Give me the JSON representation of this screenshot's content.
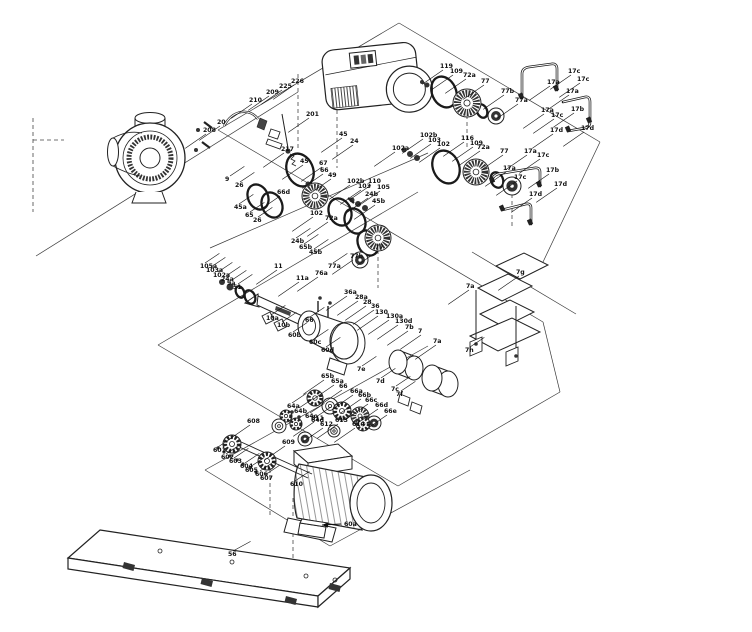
{
  "figure": {
    "type": "exploded-parts-diagram",
    "subject": "Pump assembly exploded view with numbered part callouts",
    "background_color": "#ffffff",
    "line_color": "#1a1a1a"
  },
  "part_groups": {
    "pump_head": [
      "20",
      "201",
      "208",
      "209",
      "210",
      "217",
      "225",
      "226"
    ],
    "hydraulics": [
      "9",
      "9a",
      "10a",
      "10b",
      "11",
      "11a",
      "24",
      "24a",
      "24b",
      "26",
      "45",
      "45a",
      "45b",
      "49",
      "51",
      "65",
      "65a",
      "65b",
      "66",
      "66a",
      "66b",
      "66c",
      "66d",
      "66e",
      "67",
      "76a"
    ],
    "shaft_seals": [
      "72a",
      "77",
      "77a",
      "77b",
      "102",
      "102a",
      "102b",
      "103",
      "103a",
      "105",
      "105a",
      "109",
      "110",
      "116",
      "119"
    ],
    "piping": [
      "17a",
      "17b",
      "17c",
      "17d"
    ],
    "guards_and_mounts": [
      "7",
      "7a",
      "7b",
      "7c",
      "7d",
      "7e",
      "7f",
      "7g",
      "7h",
      "28",
      "28a",
      "36",
      "36a",
      "56",
      "60a",
      "60b",
      "60c",
      "60d",
      "64a",
      "64b",
      "64c",
      "64d",
      "130",
      "130a",
      "130d"
    ],
    "fasteners": [
      "601",
      "602",
      "603",
      "604",
      "605",
      "606",
      "607",
      "608",
      "609",
      "610",
      "611",
      "612",
      "613",
      "614"
    ]
  },
  "callouts": [
    {
      "t": "208",
      "x": 203,
      "y": 132
    },
    {
      "t": "20",
      "x": 217,
      "y": 124
    },
    {
      "t": "210",
      "x": 249,
      "y": 102
    },
    {
      "t": "209",
      "x": 266,
      "y": 94
    },
    {
      "t": "225",
      "x": 279,
      "y": 88
    },
    {
      "t": "226",
      "x": 291,
      "y": 83
    },
    {
      "t": "201",
      "x": 306,
      "y": 116
    },
    {
      "t": "217",
      "x": 281,
      "y": 151
    },
    {
      "t": "9",
      "x": 225,
      "y": 181,
      "d": [
        9,
        -6
      ]
    },
    {
      "t": "26",
      "x": 235,
      "y": 187,
      "d": [
        9,
        -6
      ]
    },
    {
      "t": "45",
      "x": 339,
      "y": 136
    },
    {
      "t": "24",
      "x": 350,
      "y": 143
    },
    {
      "t": "45",
      "x": 300,
      "y": 163
    },
    {
      "t": "67",
      "x": 319,
      "y": 165
    },
    {
      "t": "66",
      "x": 320,
      "y": 172
    },
    {
      "t": "49",
      "x": 328,
      "y": 177
    },
    {
      "t": "66d",
      "x": 277,
      "y": 194
    },
    {
      "t": "45a",
      "x": 234,
      "y": 209,
      "d": [
        9,
        -6
      ]
    },
    {
      "t": "65",
      "x": 245,
      "y": 217,
      "d": [
        9,
        -6
      ]
    },
    {
      "t": "26",
      "x": 253,
      "y": 222,
      "d": [
        9,
        -6
      ]
    },
    {
      "t": "102b",
      "x": 347,
      "y": 183
    },
    {
      "t": "103",
      "x": 358,
      "y": 188
    },
    {
      "t": "110",
      "x": 368,
      "y": 183
    },
    {
      "t": "105",
      "x": 377,
      "y": 189
    },
    {
      "t": "24b",
      "x": 365,
      "y": 196
    },
    {
      "t": "45b",
      "x": 372,
      "y": 203
    },
    {
      "t": "102",
      "x": 310,
      "y": 215
    },
    {
      "t": "72a",
      "x": 325,
      "y": 220
    },
    {
      "t": "24b",
      "x": 291,
      "y": 243,
      "d": [
        9,
        -6
      ]
    },
    {
      "t": "65b",
      "x": 299,
      "y": 249,
      "d": [
        9,
        -6
      ]
    },
    {
      "t": "45b",
      "x": 309,
      "y": 254,
      "d": [
        9,
        -6
      ]
    },
    {
      "t": "77",
      "x": 375,
      "y": 249
    },
    {
      "t": "77b",
      "x": 350,
      "y": 258
    },
    {
      "t": "77a",
      "x": 328,
      "y": 268,
      "d": [
        9,
        -6
      ]
    },
    {
      "t": "102a",
      "x": 392,
      "y": 150
    },
    {
      "t": "102b",
      "x": 420,
      "y": 137
    },
    {
      "t": "103",
      "x": 428,
      "y": 142
    },
    {
      "t": "102",
      "x": 437,
      "y": 146
    },
    {
      "t": "116",
      "x": 461,
      "y": 140
    },
    {
      "t": "109",
      "x": 470,
      "y": 145
    },
    {
      "t": "72a",
      "x": 477,
      "y": 149
    },
    {
      "t": "77",
      "x": 500,
      "y": 153
    },
    {
      "t": "119",
      "x": 440,
      "y": 68
    },
    {
      "t": "109",
      "x": 450,
      "y": 73
    },
    {
      "t": "72a",
      "x": 463,
      "y": 77
    },
    {
      "t": "77",
      "x": 481,
      "y": 83
    },
    {
      "t": "77b",
      "x": 501,
      "y": 93
    },
    {
      "t": "77a",
      "x": 515,
      "y": 102
    },
    {
      "t": "17c",
      "x": 568,
      "y": 73
    },
    {
      "t": "17a",
      "x": 547,
      "y": 84
    },
    {
      "t": "17c",
      "x": 577,
      "y": 81
    },
    {
      "t": "17a",
      "x": 566,
      "y": 93
    },
    {
      "t": "17b",
      "x": 571,
      "y": 111
    },
    {
      "t": "17a",
      "x": 541,
      "y": 112
    },
    {
      "t": "17c",
      "x": 551,
      "y": 117
    },
    {
      "t": "17d",
      "x": 581,
      "y": 130
    },
    {
      "t": "17d",
      "x": 550,
      "y": 132
    },
    {
      "t": "17a",
      "x": 524,
      "y": 153
    },
    {
      "t": "17c",
      "x": 537,
      "y": 157
    },
    {
      "t": "17a",
      "x": 503,
      "y": 170
    },
    {
      "t": "17b",
      "x": 546,
      "y": 172
    },
    {
      "t": "17c",
      "x": 514,
      "y": 179
    },
    {
      "t": "17d",
      "x": 554,
      "y": 186
    },
    {
      "t": "17d",
      "x": 529,
      "y": 196
    },
    {
      "t": "105a",
      "x": 200,
      "y": 268,
      "d": [
        9,
        -6
      ]
    },
    {
      "t": "103a",
      "x": 206,
      "y": 272,
      "d": [
        9,
        -6
      ]
    },
    {
      "t": "102a",
      "x": 213,
      "y": 277,
      "d": [
        9,
        -6
      ]
    },
    {
      "t": "24a",
      "x": 221,
      "y": 281,
      "d": [
        9,
        -6
      ]
    },
    {
      "t": "9a",
      "x": 227,
      "y": 285,
      "d": [
        9,
        -6
      ]
    },
    {
      "t": "51",
      "x": 233,
      "y": 289,
      "d": [
        9,
        -6
      ]
    },
    {
      "t": "11",
      "x": 274,
      "y": 268
    },
    {
      "t": "11a",
      "x": 296,
      "y": 280
    },
    {
      "t": "76a",
      "x": 315,
      "y": 275
    },
    {
      "t": "10a",
      "x": 266,
      "y": 320,
      "d": [
        9,
        -6
      ]
    },
    {
      "t": "10b",
      "x": 277,
      "y": 327,
      "d": [
        9,
        -6
      ]
    },
    {
      "t": "66",
      "x": 305,
      "y": 322,
      "d": [
        9,
        -6
      ]
    },
    {
      "t": "36a",
      "x": 344,
      "y": 294
    },
    {
      "t": "28a",
      "x": 355,
      "y": 299
    },
    {
      "t": "28",
      "x": 363,
      "y": 304
    },
    {
      "t": "36",
      "x": 371,
      "y": 308
    },
    {
      "t": "130",
      "x": 375,
      "y": 314
    },
    {
      "t": "130a",
      "x": 386,
      "y": 318
    },
    {
      "t": "130d",
      "x": 395,
      "y": 323
    },
    {
      "t": "7b",
      "x": 405,
      "y": 329
    },
    {
      "t": "7",
      "x": 418,
      "y": 333
    },
    {
      "t": "7a",
      "x": 433,
      "y": 343
    },
    {
      "t": "7e",
      "x": 357,
      "y": 371,
      "d": [
        9,
        -6
      ]
    },
    {
      "t": "7d",
      "x": 376,
      "y": 383,
      "d": [
        9,
        -6
      ]
    },
    {
      "t": "7c",
      "x": 391,
      "y": 391,
      "d": [
        9,
        -6
      ]
    },
    {
      "t": "7f",
      "x": 396,
      "y": 396,
      "d": [
        9,
        -6
      ]
    },
    {
      "t": "60b",
      "x": 288,
      "y": 337,
      "d": [
        9,
        -6
      ]
    },
    {
      "t": "60c",
      "x": 309,
      "y": 344,
      "d": [
        9,
        -6
      ]
    },
    {
      "t": "60d",
      "x": 321,
      "y": 352,
      "d": [
        9,
        -6
      ]
    },
    {
      "t": "7g",
      "x": 516,
      "y": 274
    },
    {
      "t": "7a",
      "x": 466,
      "y": 288
    },
    {
      "t": "7h",
      "x": 465,
      "y": 352,
      "d": [
        9,
        -6
      ]
    },
    {
      "t": "65b",
      "x": 321,
      "y": 378
    },
    {
      "t": "65a",
      "x": 331,
      "y": 383
    },
    {
      "t": "66",
      "x": 339,
      "y": 388
    },
    {
      "t": "66a",
      "x": 350,
      "y": 393
    },
    {
      "t": "66b",
      "x": 358,
      "y": 397
    },
    {
      "t": "66c",
      "x": 365,
      "y": 402
    },
    {
      "t": "66d",
      "x": 375,
      "y": 407
    },
    {
      "t": "66e",
      "x": 384,
      "y": 413
    },
    {
      "t": "64a",
      "x": 287,
      "y": 408,
      "d": [
        9,
        -6
      ]
    },
    {
      "t": "64b",
      "x": 294,
      "y": 413,
      "d": [
        9,
        -6
      ]
    },
    {
      "t": "64c",
      "x": 305,
      "y": 418,
      "d": [
        9,
        -6
      ]
    },
    {
      "t": "64d",
      "x": 311,
      "y": 422,
      "d": [
        9,
        -6
      ]
    },
    {
      "t": "601",
      "x": 213,
      "y": 452,
      "d": [
        9,
        -6
      ]
    },
    {
      "t": "602",
      "x": 221,
      "y": 459,
      "d": [
        9,
        -6
      ]
    },
    {
      "t": "603",
      "x": 229,
      "y": 463,
      "d": [
        9,
        -6
      ]
    },
    {
      "t": "604",
      "x": 240,
      "y": 468,
      "d": [
        9,
        -6
      ]
    },
    {
      "t": "605",
      "x": 245,
      "y": 472,
      "d": [
        9,
        -6
      ]
    },
    {
      "t": "606",
      "x": 255,
      "y": 476,
      "d": [
        9,
        -6
      ]
    },
    {
      "t": "607",
      "x": 260,
      "y": 480,
      "d": [
        9,
        -6
      ]
    },
    {
      "t": "608",
      "x": 247,
      "y": 423
    },
    {
      "t": "609",
      "x": 282,
      "y": 444
    },
    {
      "t": "610",
      "x": 290,
      "y": 486,
      "d": [
        9,
        -6
      ]
    },
    {
      "t": "611",
      "x": 311,
      "y": 420
    },
    {
      "t": "612",
      "x": 320,
      "y": 426
    },
    {
      "t": "613",
      "x": 335,
      "y": 422
    },
    {
      "t": "614",
      "x": 352,
      "y": 426
    },
    {
      "t": "56",
      "x": 228,
      "y": 556,
      "d": [
        11,
        -6
      ]
    },
    {
      "t": "60a",
      "x": 344,
      "y": 526,
      "a": true
    }
  ]
}
